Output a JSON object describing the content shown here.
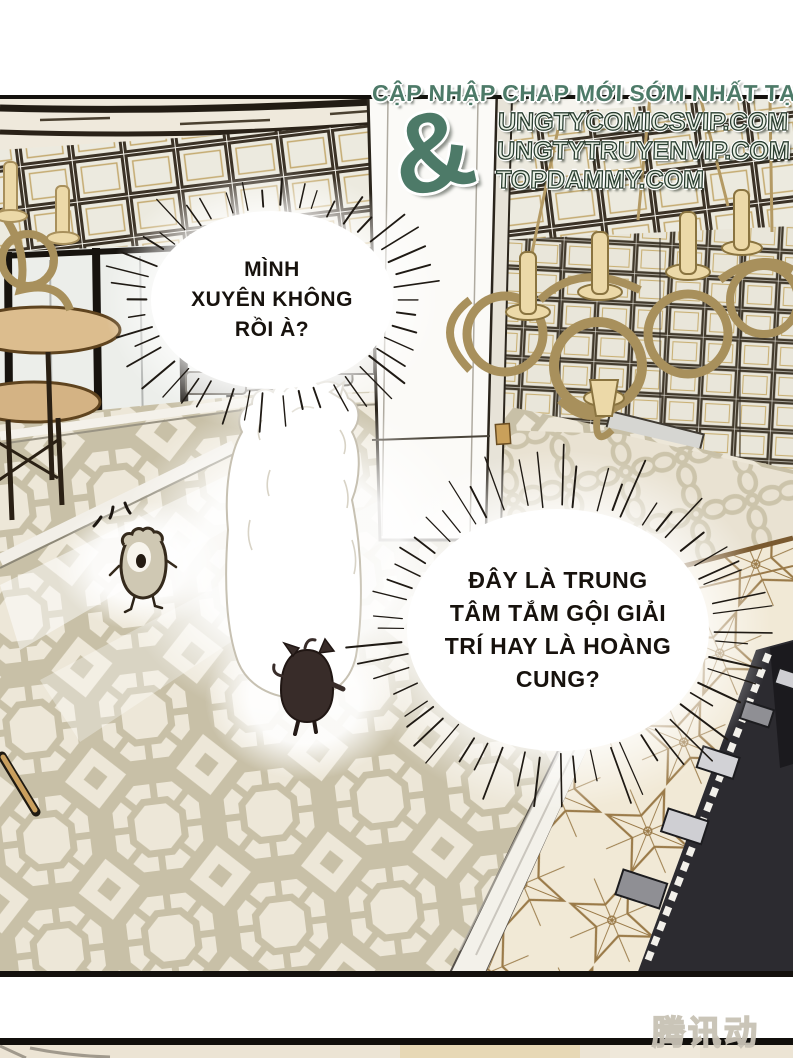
{
  "header": {
    "tagline": "CẬP NHẬP CHAP MỚI SỚM NHẤT TẠI",
    "ampersand": "&",
    "sites": [
      "UNGTYCOMICSVIP.COM",
      "UNGTYTRUYENVIP.COM",
      "TOPDAMMY.COM"
    ]
  },
  "bubbles": [
    {
      "speaker": "wolf",
      "lines": [
        "MÌNH",
        "XUYÊN KHÔNG",
        "RỒI À?"
      ]
    },
    {
      "speaker": "wolf",
      "lines": [
        "ĐÂY LÀ TRUNG",
        "TÂM TẮM GỘI GIẢI",
        "TRÍ HAY LÀ HOÀNG",
        "CUNG?"
      ]
    }
  ],
  "watermark": {
    "text": "腾讯动漫"
  },
  "colors": {
    "promo_green": "#4d7a68",
    "promo_letter_fill": "#eaf0e6",
    "chandelier_gold": "#e9d5a2",
    "carpet_tan": "#c8c0a7",
    "carpet_cream": "#ede7d8",
    "tile_gold_line": "#9a7a48",
    "desk_black": "#2c2b30",
    "watermark_grey": "#c8c2b5"
  }
}
